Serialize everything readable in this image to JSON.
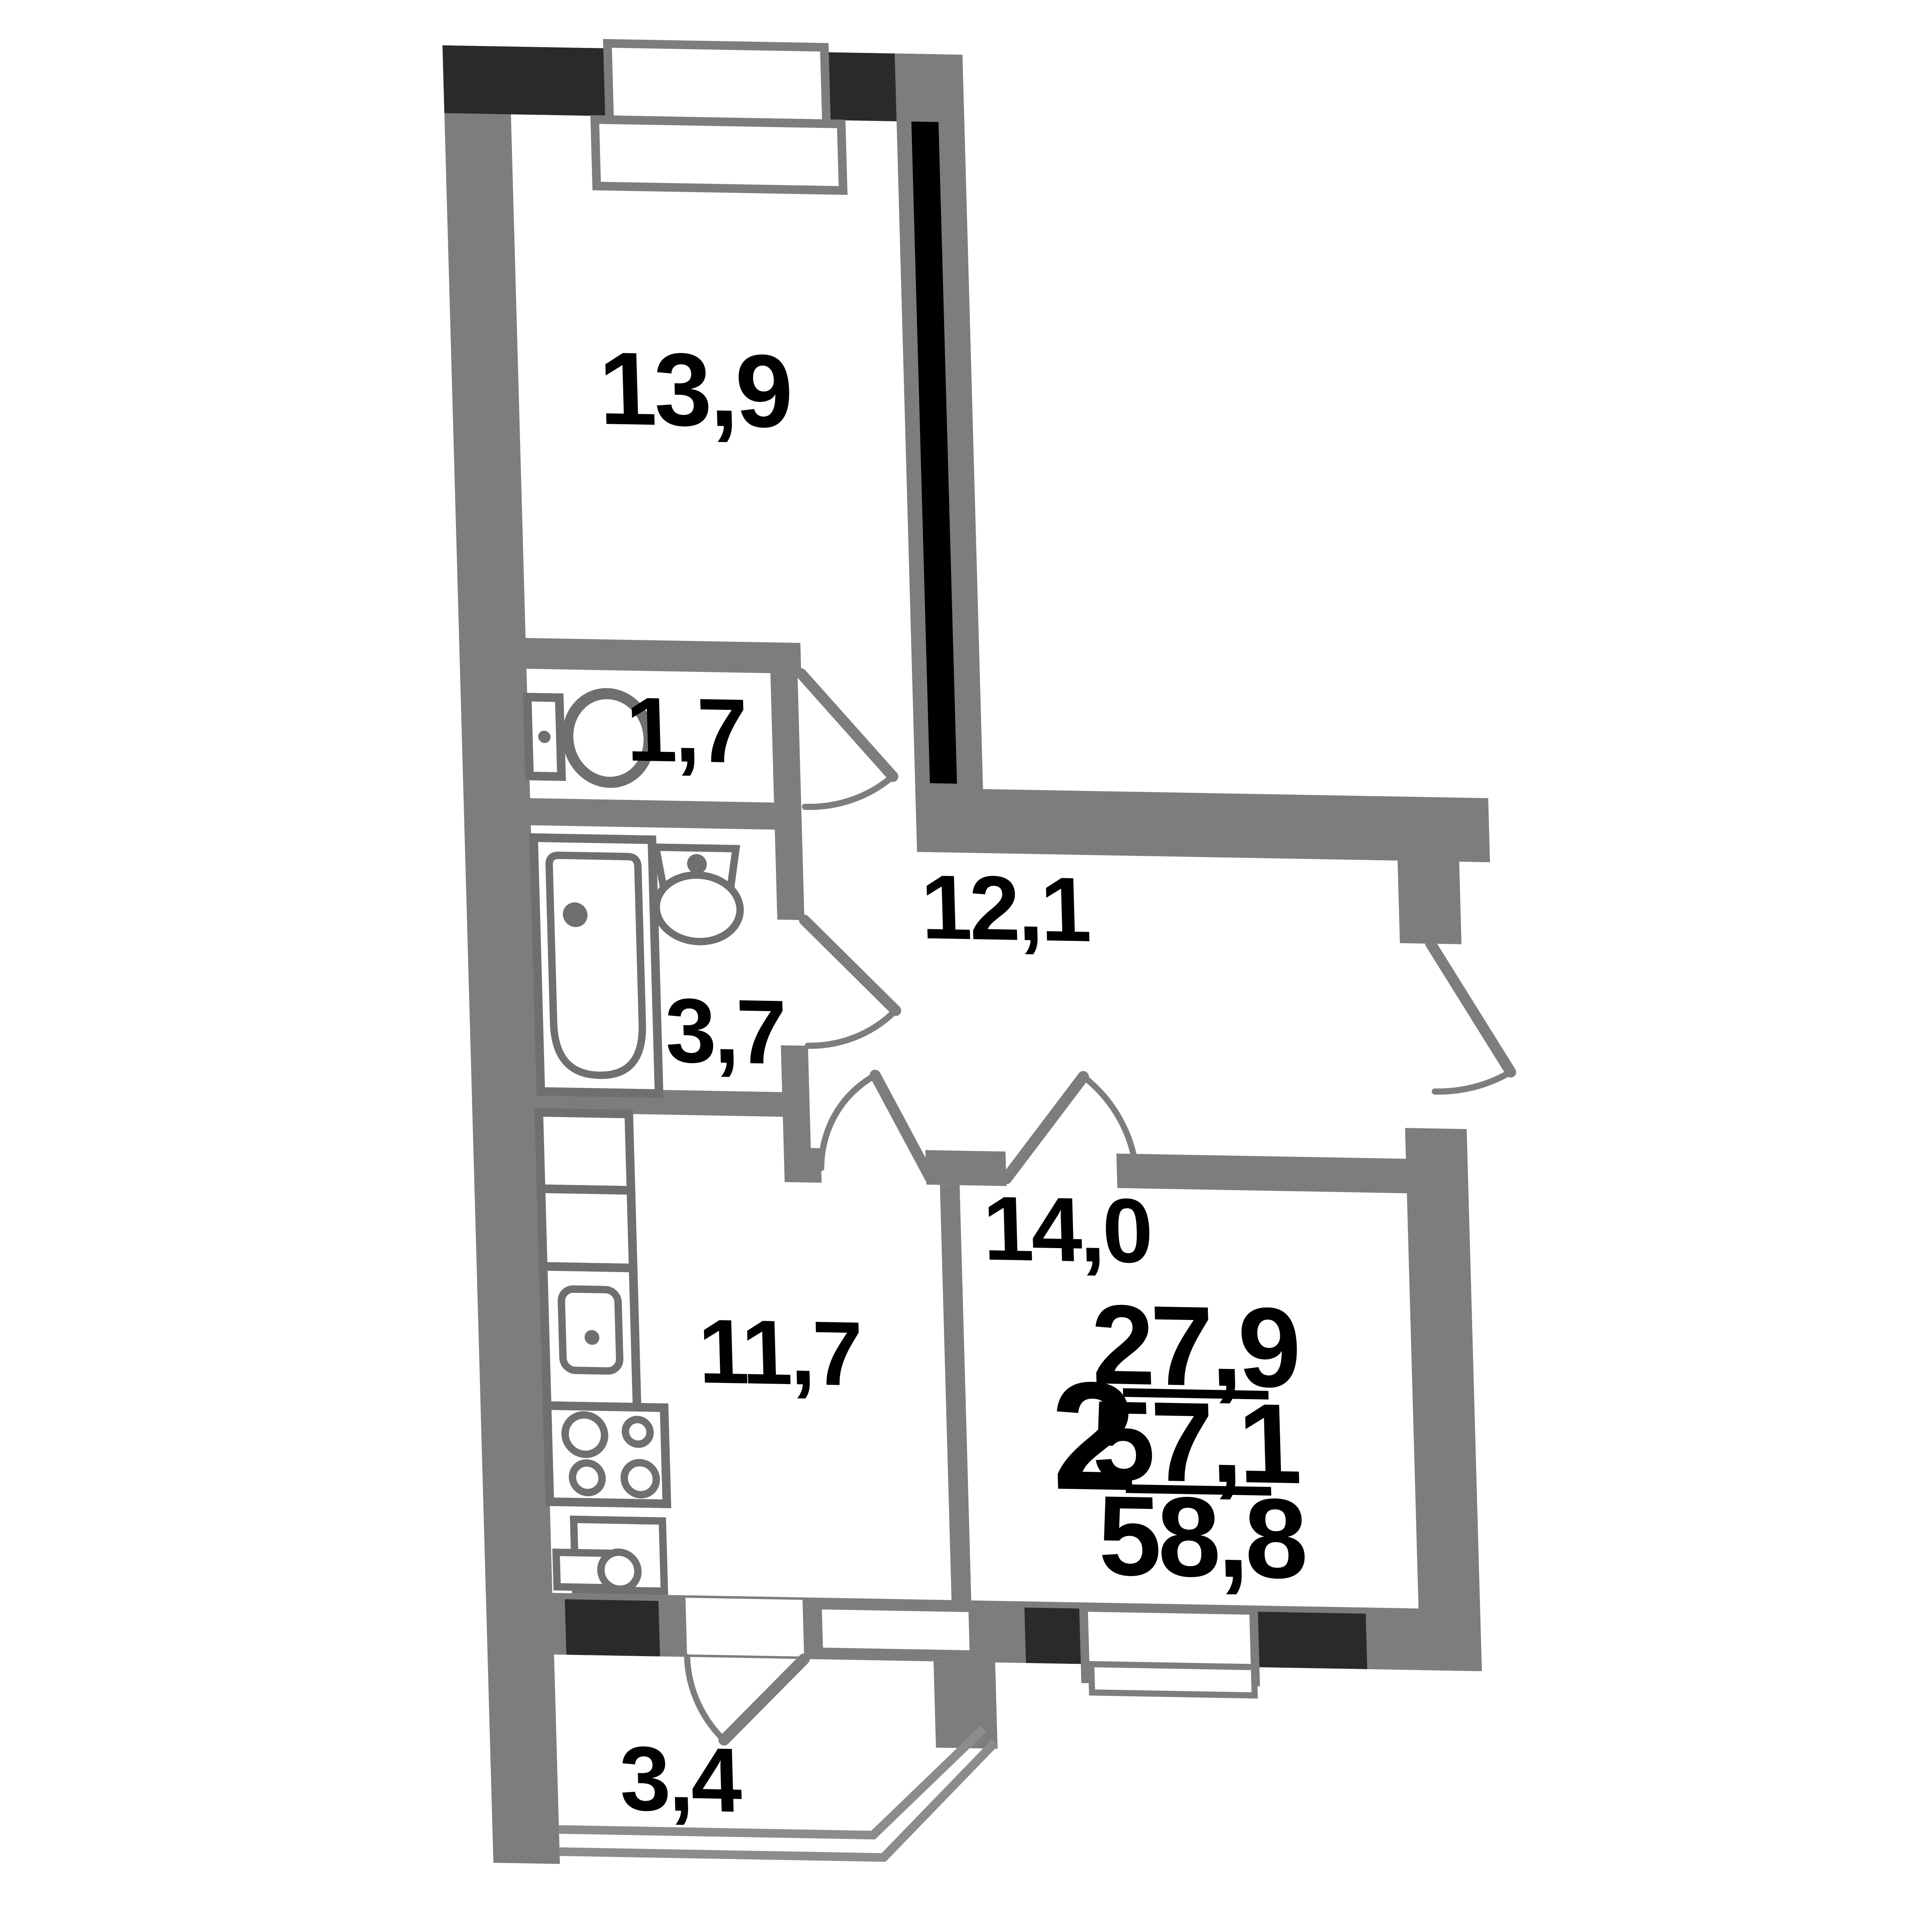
{
  "plan": {
    "type": "apartment-floor-plan",
    "rooms": [
      {
        "id": "bedroom",
        "area": "13,9"
      },
      {
        "id": "wc",
        "area": "1,7"
      },
      {
        "id": "bathroom",
        "area": "3,7"
      },
      {
        "id": "hallway",
        "area": "12,1"
      },
      {
        "id": "living-room",
        "area": "14,0"
      },
      {
        "id": "kitchen",
        "area": "11,7"
      },
      {
        "id": "balcony",
        "area": "3,4"
      }
    ],
    "summary": {
      "rooms_count": "2",
      "living_area": "27,9",
      "apartment_area": "57,1",
      "total_area": "58,8"
    },
    "icons": [
      "toilet-icon",
      "bathtub-icon",
      "washbasin-icon",
      "kitchen-sink-icon",
      "stove-icon",
      "washing-machine-icon"
    ],
    "colors": {
      "wall": "#7d7d7d",
      "accent_wall": "#2b2a29",
      "fixture_stroke": "#6f6f6f",
      "background": "#ffffff",
      "text": "#000000"
    }
  }
}
